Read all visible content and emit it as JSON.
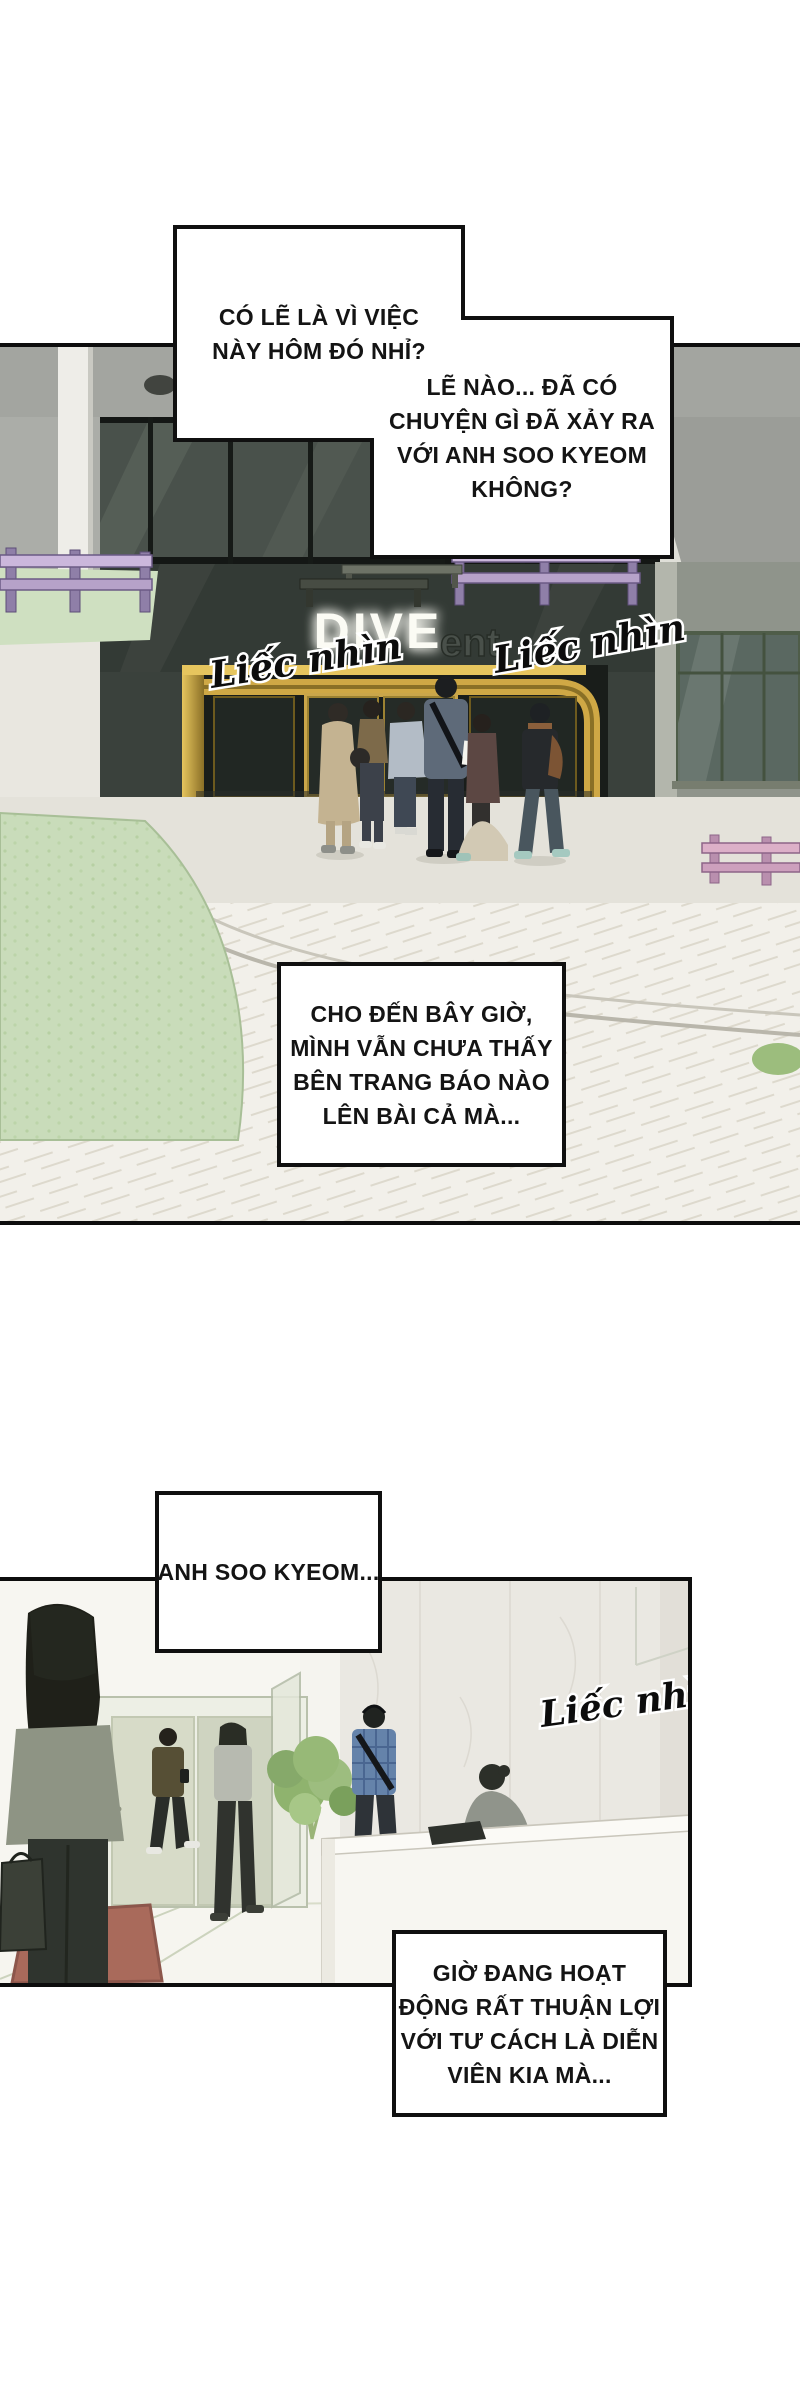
{
  "page": {
    "width": 800,
    "height": 2400,
    "background": "#ffffff"
  },
  "bubbles": {
    "b1": {
      "lines": [
        "CÓ LẼ LÀ VÌ VIỆC",
        "NÀY HÔM ĐÓ NHỈ?"
      ]
    },
    "b2": {
      "lines": [
        "LẼ NÀO... ĐÃ CÓ",
        "CHUYỆN GÌ ĐÃ XẢY RA",
        "VỚI ANH SOO KYEOM",
        "KHÔNG?"
      ]
    },
    "b3": {
      "lines": [
        "CHO ĐẾN BÂY GIỜ,",
        "MÌNH VẪN CHƯA THẤY",
        "BÊN TRANG BÁO NÀO",
        "LÊN BÀI CẢ MÀ..."
      ]
    },
    "b4": {
      "lines": [
        "ANH SOO KYEOM..."
      ]
    },
    "b5": {
      "lines": [
        "GIỜ ĐANG HOẠT",
        "ĐỘNG RẤT THUẬN LỢI",
        "VỚI TƯ CÁCH LÀ DIỄN",
        "VIÊN KIA MÀ..."
      ]
    }
  },
  "panel1": {
    "sign": {
      "main": "DIVE",
      "sub": "ent"
    },
    "watermarks": {
      "left": "Liếc nhìn",
      "right": "Liếc nhìn"
    }
  },
  "panel2": {
    "watermark": "Liếc nhìn"
  },
  "colors": {
    "bubble_border": "#101010",
    "sign_glow": "#fbfbf4",
    "entrance_gold": "#d0a946",
    "facade_charcoal": "#3a413c",
    "lawn_green": "#c9dcba",
    "fence_purple": "#cbb7dc",
    "fence_pink": "#dcb0c8",
    "tree_green": "#8fb36e",
    "mat_red": "#a96a5b"
  }
}
